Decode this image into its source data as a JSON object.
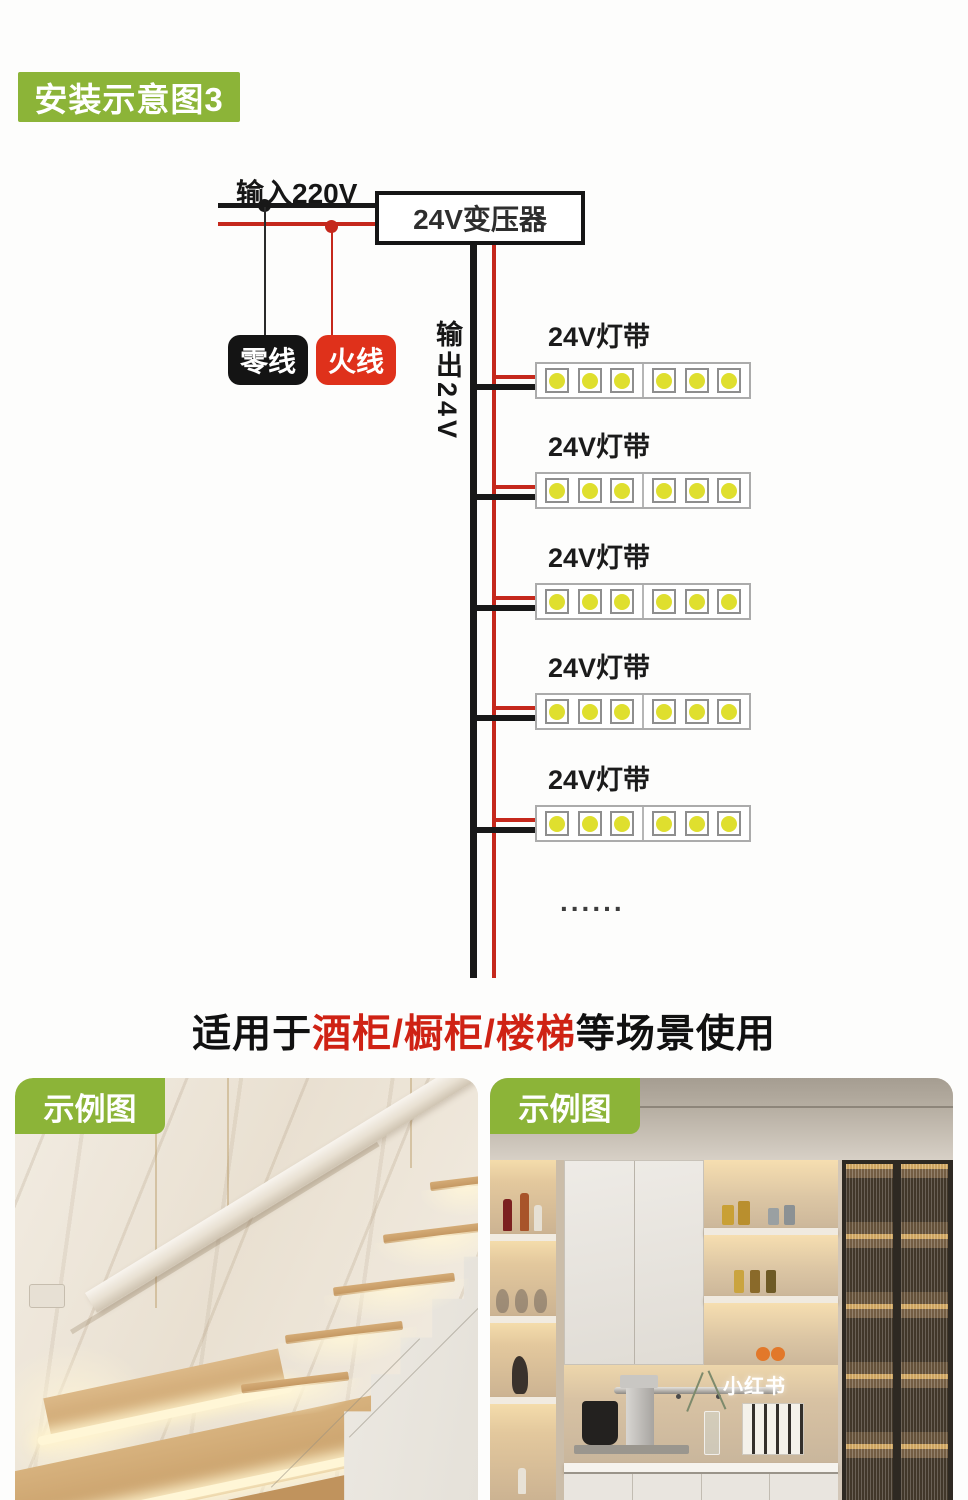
{
  "header_badge": {
    "label": "安装示意图3"
  },
  "diagram": {
    "input_label": "输入220V",
    "transformer_label": "24V变压器",
    "neutral_label": "零线",
    "live_label": "火线",
    "output_label": "输出24V",
    "ellipsis": "......",
    "strips": [
      {
        "label": "24V灯带"
      },
      {
        "label": "24V灯带"
      },
      {
        "label": "24V灯带"
      },
      {
        "label": "24V灯带"
      },
      {
        "label": "24V灯带"
      }
    ]
  },
  "scene_title": {
    "prefix": "适用于",
    "highlight": "酒柜/橱柜/楼梯",
    "suffix": "等场景使用"
  },
  "examples": {
    "left_badge": "示例图",
    "right_badge": "示例图",
    "watermark": "小红书"
  },
  "colors": {
    "accent_green": "#8cb438",
    "wire_red": "#c5281c",
    "live_badge_red": "#df311b",
    "neutral_badge_black": "#141414",
    "wire_black": "#1a1a1a",
    "led_yellow": "#dfdf2e",
    "title_red": "#cf2214"
  }
}
